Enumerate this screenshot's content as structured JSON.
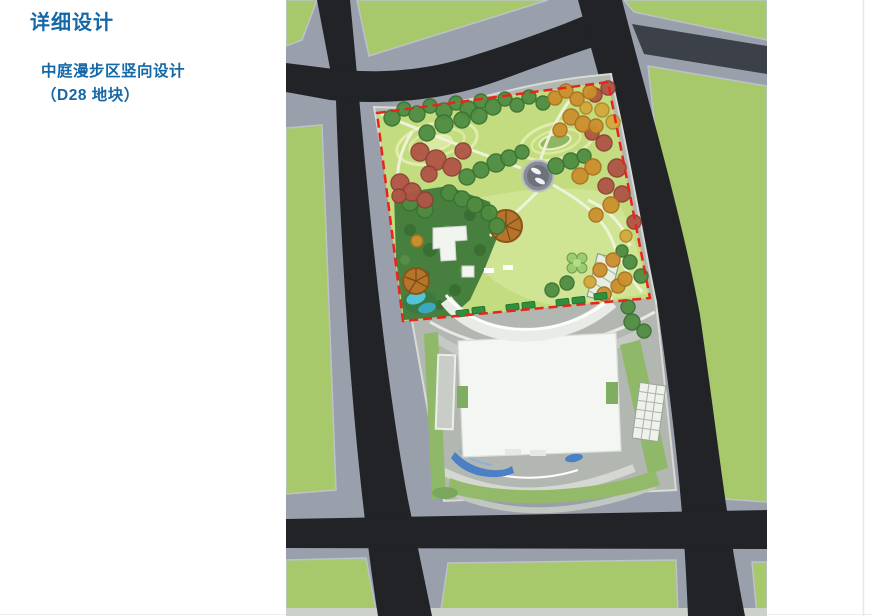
{
  "slide": {
    "title": "详细设计",
    "subtitle_line1": "中庭漫步区竖向设计",
    "subtitle_line2": "（D28 地块）"
  },
  "map": {
    "kind": "site-plan-aerial-rendering",
    "plot_label": "D28",
    "colors": {
      "road": "#212327",
      "road_minor": "#4a4f58",
      "sidewalk": "#9aa0ab",
      "city_block_green": "#a7c96c",
      "plaza": "#b3b7b1",
      "plaza_edge": "#d8dbd5",
      "park_lawn": "#c3dc80",
      "park_lawn_light": "#cfe594",
      "mound_ring": "#e2edad",
      "mound_pond": "#8fb763",
      "woodland": "#47803e",
      "boundary_red": "#e8241c",
      "water_blue": "#4b80c6",
      "pool_cyan": "#52c4d6",
      "building_white": "#f3f6f2",
      "building_edge": "#d9ded8",
      "car_green": "#2f8f3e",
      "path_light": "#eef2d8",
      "band_pale": "#cdd1cb",
      "tree_green": "#4f8c42",
      "tree_red": "#b05544",
      "tree_orange": "#cc8f2e",
      "tree_yellow": "#d2a93c",
      "dome_outer": "#878c94",
      "dome_inner": "#6e737b"
    },
    "trees": [
      [
        392,
        118,
        8,
        "g"
      ],
      [
        404,
        109,
        7,
        "g"
      ],
      [
        417,
        114,
        8,
        "g"
      ],
      [
        430,
        106,
        7,
        "g"
      ],
      [
        444,
        111,
        8,
        "g"
      ],
      [
        456,
        103,
        7,
        "g"
      ],
      [
        468,
        109,
        8,
        "g"
      ],
      [
        481,
        101,
        7,
        "g"
      ],
      [
        493,
        107,
        8,
        "g"
      ],
      [
        505,
        99,
        7,
        "g"
      ],
      [
        517,
        105,
        7,
        "g"
      ],
      [
        529,
        97,
        7,
        "g"
      ],
      [
        543,
        103,
        7,
        "g"
      ],
      [
        444,
        124,
        9,
        "g"
      ],
      [
        462,
        120,
        8,
        "g"
      ],
      [
        479,
        116,
        8,
        "g"
      ],
      [
        427,
        133,
        8,
        "g"
      ],
      [
        496,
        163,
        9,
        "g"
      ],
      [
        481,
        170,
        8,
        "g"
      ],
      [
        467,
        177,
        8,
        "g"
      ],
      [
        509,
        158,
        8,
        "g"
      ],
      [
        522,
        152,
        7,
        "g"
      ],
      [
        556,
        166,
        8,
        "g"
      ],
      [
        571,
        161,
        8,
        "g"
      ],
      [
        584,
        156,
        7,
        "g"
      ],
      [
        449,
        193,
        8,
        "g"
      ],
      [
        462,
        199,
        8,
        "g"
      ],
      [
        475,
        205,
        8,
        "g"
      ],
      [
        489,
        213,
        8,
        "g"
      ],
      [
        497,
        226,
        8,
        "g"
      ],
      [
        425,
        210,
        8,
        "g"
      ],
      [
        410,
        203,
        8,
        "g"
      ],
      [
        630,
        262,
        7,
        "g"
      ],
      [
        641,
        276,
        7,
        "g"
      ],
      [
        622,
        251,
        6,
        "g"
      ],
      [
        567,
        283,
        7,
        "g"
      ],
      [
        552,
        290,
        7,
        "g"
      ],
      [
        632,
        322,
        8,
        "g"
      ],
      [
        644,
        331,
        7,
        "g"
      ],
      [
        628,
        307,
        7,
        "g"
      ],
      [
        420,
        152,
        9,
        "r"
      ],
      [
        436,
        160,
        10,
        "r"
      ],
      [
        452,
        167,
        9,
        "r"
      ],
      [
        429,
        174,
        8,
        "r"
      ],
      [
        463,
        151,
        8,
        "r"
      ],
      [
        400,
        183,
        9,
        "r"
      ],
      [
        412,
        192,
        9,
        "r"
      ],
      [
        425,
        200,
        8,
        "r"
      ],
      [
        399,
        196,
        7,
        "r"
      ],
      [
        604,
        143,
        8,
        "r"
      ],
      [
        617,
        168,
        9,
        "r"
      ],
      [
        606,
        186,
        8,
        "r"
      ],
      [
        622,
        194,
        8,
        "r"
      ],
      [
        592,
        133,
        7,
        "r"
      ],
      [
        634,
        222,
        7,
        "r"
      ],
      [
        608,
        88,
        7,
        "r"
      ],
      [
        595,
        95,
        7,
        "r"
      ],
      [
        555,
        98,
        7,
        "o"
      ],
      [
        566,
        91,
        7,
        "o"
      ],
      [
        577,
        99,
        7,
        "o"
      ],
      [
        590,
        92,
        7,
        "o"
      ],
      [
        571,
        117,
        8,
        "o"
      ],
      [
        583,
        124,
        8,
        "o"
      ],
      [
        596,
        126,
        7,
        "o"
      ],
      [
        560,
        130,
        7,
        "o"
      ],
      [
        593,
        167,
        8,
        "o"
      ],
      [
        580,
        176,
        8,
        "o"
      ],
      [
        611,
        205,
        8,
        "o"
      ],
      [
        596,
        215,
        7,
        "o"
      ],
      [
        613,
        260,
        7,
        "o"
      ],
      [
        600,
        270,
        7,
        "o"
      ],
      [
        618,
        286,
        7,
        "o"
      ],
      [
        604,
        294,
        7,
        "o"
      ],
      [
        417,
        241,
        6,
        "o"
      ],
      [
        625,
        279,
        7,
        "o"
      ],
      [
        602,
        110,
        7,
        "y"
      ],
      [
        613,
        122,
        7,
        "y"
      ],
      [
        586,
        108,
        6,
        "y"
      ],
      [
        626,
        236,
        6,
        "y"
      ],
      [
        590,
        282,
        6,
        "y"
      ]
    ]
  }
}
